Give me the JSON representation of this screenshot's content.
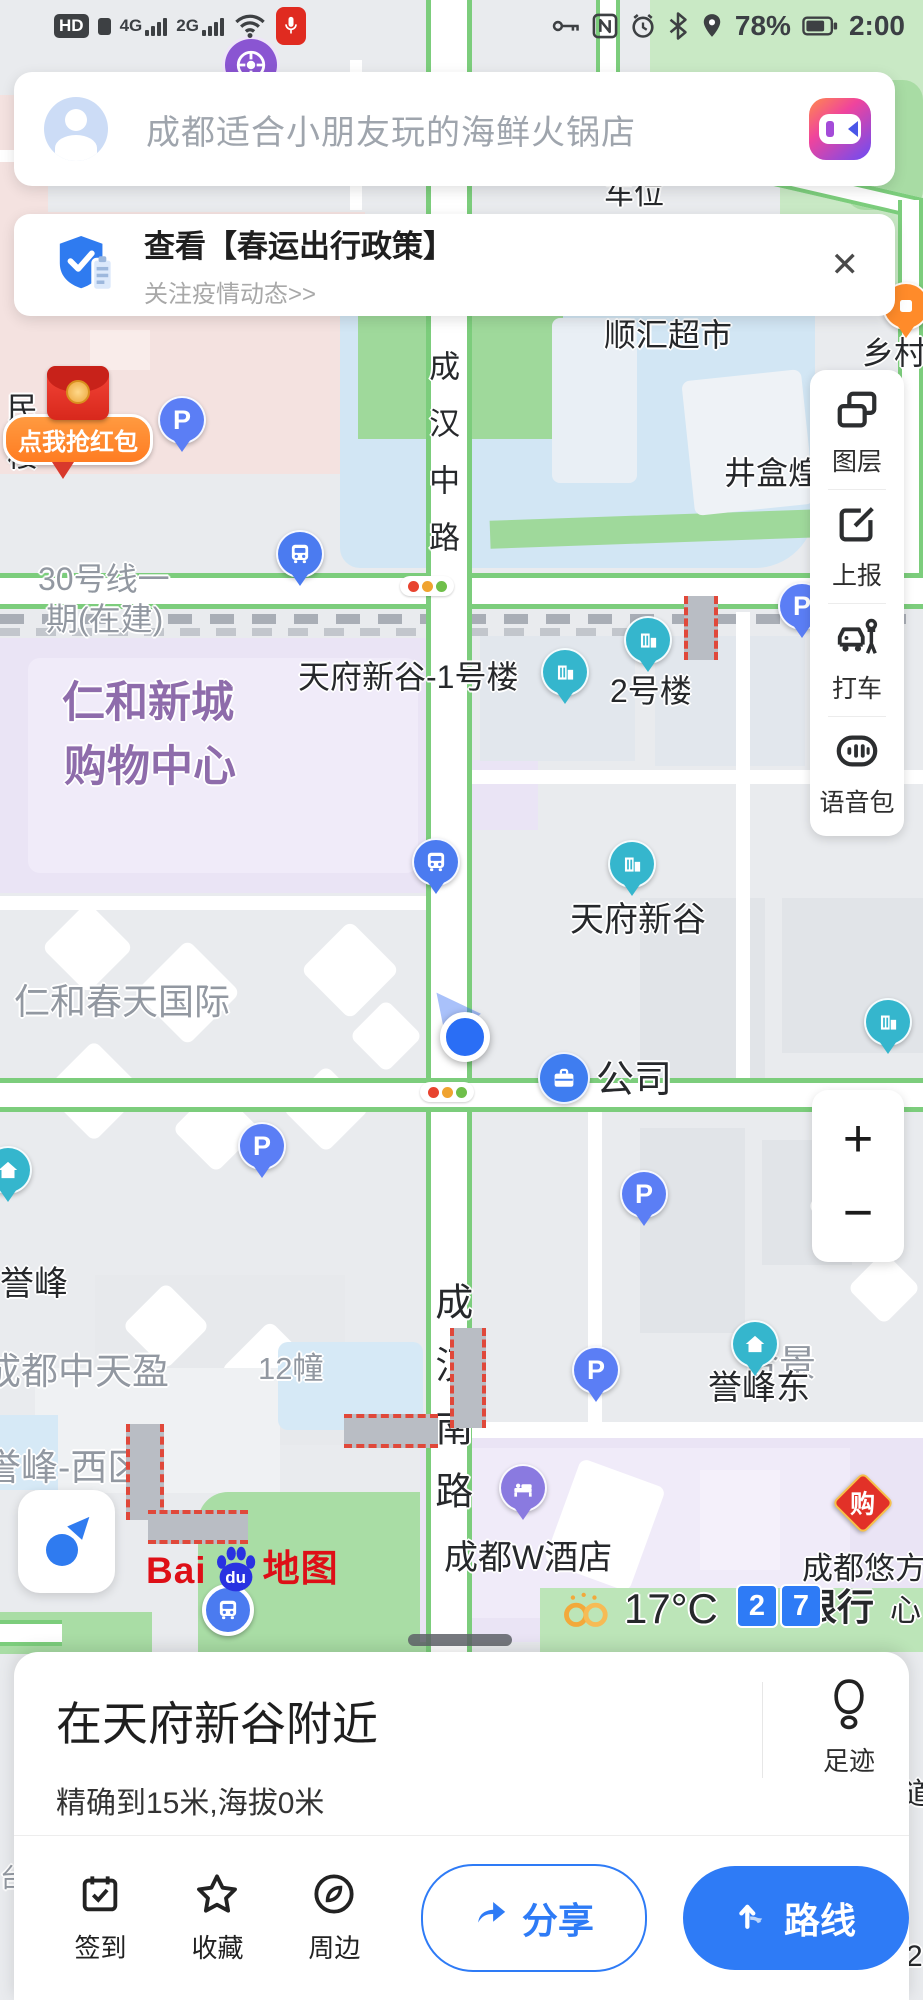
{
  "status_bar": {
    "hd": "HD",
    "net1": "4G",
    "net2": "2G",
    "battery": "78%",
    "time": "2:00"
  },
  "search": {
    "placeholder": "成都适合小朋友玩的海鲜火锅店"
  },
  "banner": {
    "title": "查看【春运出行政策】",
    "subtitle": "关注疫情动态>>",
    "close": "✕"
  },
  "tools": {
    "layers": "图层",
    "report": "上报",
    "taxi": "打车",
    "voice": "语音包"
  },
  "zoom_controls": {
    "zoom_in": "+",
    "zoom_out": "−"
  },
  "logo": {
    "bai": "Bai",
    "du": "du",
    "map_word": "地图"
  },
  "sheet": {
    "title": "在天府新谷附近",
    "accuracy": "精确到15米,海拔0米",
    "footprint": "足迹",
    "checkin": "签到",
    "favorite": "收藏",
    "nearby": "周边",
    "share": "分享",
    "route": "路线"
  },
  "map": {
    "labels": [
      {
        "text": "车位",
        "x": 604,
        "y": 178,
        "cls": "k",
        "size": 30
      },
      {
        "text": "顺汇超市",
        "x": 604,
        "y": 318,
        "cls": "k",
        "size": 32
      },
      {
        "text": "乡村基",
        "x": 862,
        "y": 336,
        "cls": "k",
        "size": 32
      },
      {
        "text": "井盒煌",
        "x": 724,
        "y": 456,
        "cls": "k",
        "size": 32
      },
      {
        "text": "成汉中路",
        "x": 424,
        "y": 350,
        "cls": "k lv",
        "size": 31,
        "ls": 26
      },
      {
        "text": "民楼",
        "x": 2,
        "y": 392,
        "cls": "k lv",
        "size": 31,
        "ls": 16
      },
      {
        "text": "30号线一",
        "x": 38,
        "y": 562,
        "cls": "g",
        "size": 32
      },
      {
        "text": "期(在建)",
        "x": 46,
        "y": 602,
        "cls": "g",
        "size": 32
      },
      {
        "text": "天府新谷-1号楼",
        "x": 298,
        "y": 660,
        "cls": "k",
        "size": 32
      },
      {
        "text": "2号楼",
        "x": 610,
        "y": 674,
        "cls": "k",
        "size": 32
      },
      {
        "text": "仁和新城",
        "x": 62,
        "y": 680,
        "cls": "v",
        "size": 43
      },
      {
        "text": "购物中心",
        "x": 64,
        "y": 744,
        "cls": "v",
        "size": 43
      },
      {
        "text": "天府新谷",
        "x": 570,
        "y": 902,
        "cls": "k",
        "size": 34
      },
      {
        "text": "仁和春天国际",
        "x": 14,
        "y": 982,
        "cls": "g",
        "size": 36
      },
      {
        "text": "公司",
        "x": 596,
        "y": 1060,
        "cls": "k",
        "size": 38
      },
      {
        "text": "誉峰",
        "x": 0,
        "y": 1266,
        "cls": "k",
        "size": 34
      },
      {
        "text": "成都中天盈",
        "x": -16,
        "y": 1352,
        "cls": "g",
        "size": 37
      },
      {
        "text": "12幢",
        "x": 258,
        "y": 1352,
        "cls": "g",
        "size": 31
      },
      {
        "text": "合景",
        "x": 742,
        "y": 1344,
        "cls": "g",
        "size": 37
      },
      {
        "text": "誉峰-西区",
        "x": -16,
        "y": 1448,
        "cls": "g",
        "size": 37
      },
      {
        "text": "成汉南路",
        "x": 428,
        "y": 1282,
        "cls": "k lv",
        "size": 38,
        "ls": 25
      },
      {
        "text": "誉峰东",
        "x": 708,
        "y": 1370,
        "cls": "k",
        "size": 34
      },
      {
        "text": "成都W酒店",
        "x": 444,
        "y": 1540,
        "cls": "k",
        "size": 34
      },
      {
        "text": "成都悠方",
        "x": 802,
        "y": 1552,
        "cls": "k",
        "size": 31
      },
      {
        "text": "限行",
        "x": 800,
        "y": 1588,
        "cls": "k bold",
        "size": 37
      },
      {
        "text": "心",
        "x": 890,
        "y": 1594,
        "cls": "k",
        "size": 31
      },
      {
        "text": "17°C",
        "x": 624,
        "y": 1586,
        "cls": "k",
        "size": 42
      },
      {
        "text": "道",
        "x": 904,
        "y": 1778,
        "cls": "k",
        "size": 30
      },
      {
        "text": "2",
        "x": 906,
        "y": 1940,
        "cls": "k",
        "size": 30
      },
      {
        "text": "台",
        "x": 0,
        "y": 1864,
        "cls": "g",
        "size": 26
      }
    ],
    "markers": [
      {
        "type": "metro-circle",
        "x": 222,
        "y": 36
      },
      {
        "type": "orange-pin",
        "x": 882,
        "y": 282
      },
      {
        "type": "red-envelope",
        "x": 16,
        "y": 366,
        "text": "点我抢红包"
      },
      {
        "type": "p-pin",
        "x": 158,
        "y": 396
      },
      {
        "type": "bus-pin",
        "x": 276,
        "y": 530
      },
      {
        "type": "traffic-light",
        "x": 400,
        "y": 576
      },
      {
        "type": "construction-v",
        "x": 684,
        "y": 596,
        "w": 26,
        "h": 64
      },
      {
        "type": "p-pin",
        "x": 778,
        "y": 582
      },
      {
        "type": "building-pin",
        "x": 624,
        "y": 616
      },
      {
        "type": "building-pin",
        "x": 541,
        "y": 648
      },
      {
        "type": "building-pin",
        "x": 608,
        "y": 840
      },
      {
        "type": "bus-pin",
        "x": 412,
        "y": 838
      },
      {
        "type": "location-puck",
        "x": 440,
        "y": 1012
      },
      {
        "type": "company-badge",
        "x": 538,
        "y": 1052
      },
      {
        "type": "building-pin",
        "x": 864,
        "y": 998
      },
      {
        "type": "traffic-light",
        "x": 420,
        "y": 1082
      },
      {
        "type": "p-pin",
        "x": 238,
        "y": 1122
      },
      {
        "type": "home-pin",
        "x": -16,
        "y": 1146
      },
      {
        "type": "p-pin",
        "x": 620,
        "y": 1170
      },
      {
        "type": "home-pin",
        "x": 731,
        "y": 1320
      },
      {
        "type": "construction-v",
        "x": 450,
        "y": 1328,
        "w": 28,
        "h": 100
      },
      {
        "type": "construction-h",
        "x": 344,
        "y": 1414,
        "w": 94,
        "h": 26
      },
      {
        "type": "construction-v",
        "x": 126,
        "y": 1424,
        "w": 30,
        "h": 96
      },
      {
        "type": "construction-h",
        "x": 148,
        "y": 1510,
        "w": 100,
        "h": 26
      },
      {
        "type": "p-pin",
        "x": 572,
        "y": 1346
      },
      {
        "type": "shop-badge",
        "x": 836,
        "y": 1476,
        "text": "购"
      },
      {
        "type": "hotel-pin",
        "x": 499,
        "y": 1464
      },
      {
        "type": "weather-rings",
        "x": 560,
        "y": 1592
      },
      {
        "type": "plate",
        "x": 736,
        "y": 1584,
        "text": "2"
      },
      {
        "type": "plate",
        "x": 780,
        "y": 1584,
        "text": "7"
      },
      {
        "type": "bus-circle",
        "x": 202,
        "y": 1584
      }
    ]
  }
}
